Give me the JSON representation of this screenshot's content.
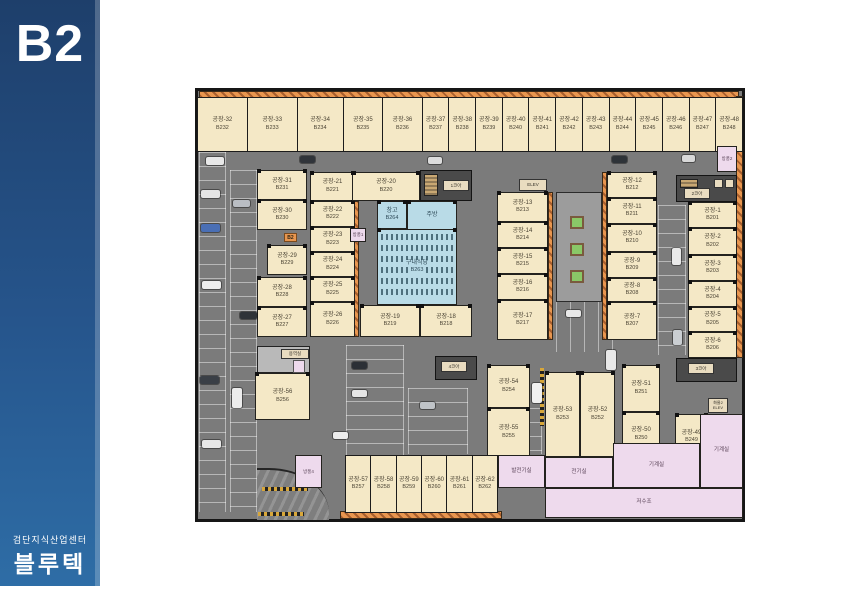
{
  "banner": {
    "level": "B2",
    "subtitle": "검단지식산업센터",
    "name": "블루텍"
  },
  "top_row": [
    {
      "label": "공장-32",
      "code": "B232"
    },
    {
      "label": "공장-33",
      "code": "B233"
    },
    {
      "label": "공장-34",
      "code": "B234"
    },
    {
      "label": "공장-35",
      "code": "B235"
    },
    {
      "label": "공장-36",
      "code": "B236"
    },
    {
      "label": "공장-37",
      "code": "B237"
    },
    {
      "label": "공장-38",
      "code": "B238"
    },
    {
      "label": "공장-39",
      "code": "B239"
    },
    {
      "label": "공장-40",
      "code": "B240"
    },
    {
      "label": "공장-41",
      "code": "B241"
    },
    {
      "label": "공장-42",
      "code": "B242"
    },
    {
      "label": "공장-43",
      "code": "B243"
    },
    {
      "label": "공장-44",
      "code": "B244"
    },
    {
      "label": "공장-45",
      "code": "B245"
    },
    {
      "label": "공장-46",
      "code": "B246"
    },
    {
      "label": "공장-47",
      "code": "B247"
    },
    {
      "label": "공장-48",
      "code": "B248"
    }
  ],
  "left_col_a": [
    {
      "label": "공장-31",
      "code": "B231"
    },
    {
      "label": "공장-30",
      "code": "B230"
    },
    {
      "label": "공장-29",
      "code": "B229"
    },
    {
      "label": "공장-28",
      "code": "B228"
    },
    {
      "label": "공장-27",
      "code": "B227"
    }
  ],
  "left_col_b": [
    {
      "label": "공장-21",
      "code": "B221"
    },
    {
      "label": "공장-22",
      "code": "B222"
    },
    {
      "label": "공장-23",
      "code": "B223"
    },
    {
      "label": "공장-24",
      "code": "B224"
    },
    {
      "label": "공장-25",
      "code": "B225"
    },
    {
      "label": "공장-26",
      "code": "B226"
    }
  ],
  "center": {
    "f20": {
      "label": "공장-20",
      "code": "B220"
    },
    "storage": {
      "label": "창고",
      "code": "B264"
    },
    "kitchen": {
      "label": "주방"
    },
    "cafeteria": {
      "label": "구내식당",
      "code": "B263"
    },
    "f19": {
      "label": "공장-19",
      "code": "B219"
    },
    "f18": {
      "label": "공장-18",
      "code": "B218"
    }
  },
  "mid_col": [
    {
      "label": "공장-13",
      "code": "B213"
    },
    {
      "label": "공장-14",
      "code": "B214"
    },
    {
      "label": "공장-15",
      "code": "B215"
    },
    {
      "label": "공장-16",
      "code": "B216"
    },
    {
      "label": "공장-17",
      "code": "B217"
    }
  ],
  "right_col": [
    {
      "label": "공장-12",
      "code": "B212"
    },
    {
      "label": "공장-11",
      "code": "B211"
    },
    {
      "label": "공장-10",
      "code": "B210"
    },
    {
      "label": "공장-9",
      "code": "B209"
    },
    {
      "label": "공장-8",
      "code": "B208"
    },
    {
      "label": "공장-7",
      "code": "B207"
    }
  ],
  "far_col": [
    {
      "label": "공장-1",
      "code": "B201"
    },
    {
      "label": "공장-2",
      "code": "B202"
    },
    {
      "label": "공장-3",
      "code": "B203"
    },
    {
      "label": "공장-4",
      "code": "B204"
    },
    {
      "label": "공장-5",
      "code": "B205"
    },
    {
      "label": "공장-6",
      "code": "B206"
    }
  ],
  "bottom_block": {
    "f54": {
      "label": "공장-54",
      "code": "B254"
    },
    "f55": {
      "label": "공장-55",
      "code": "B255"
    },
    "f53": {
      "label": "공장-53",
      "code": "B253"
    },
    "f52": {
      "label": "공장-52",
      "code": "B252"
    },
    "f51": {
      "label": "공장-51",
      "code": "B251"
    },
    "f50": {
      "label": "공장-50",
      "code": "B250"
    },
    "f49": {
      "label": "공장-49",
      "code": "B249"
    }
  },
  "bottom_row": [
    {
      "label": "공장-57",
      "code": "B257"
    },
    {
      "label": "공장-58",
      "code": "B258"
    },
    {
      "label": "공장-59",
      "code": "B259"
    },
    {
      "label": "공장-60",
      "code": "B260"
    },
    {
      "label": "공장-61",
      "code": "B261"
    },
    {
      "label": "공장-62",
      "code": "B262"
    }
  ],
  "f56": {
    "label": "공장-56",
    "code": "B256"
  },
  "cores": {
    "c1": "1코아",
    "c2": "2코아",
    "c3": "3코아",
    "c4": "4코아"
  },
  "utility": {
    "generator": "발전기실",
    "electrical": "전기실",
    "mechanical1": "기계실",
    "mechanical2": "기계실",
    "water_tank": "저수조",
    "service": "용역실"
  },
  "vestibules": {
    "v1": "방풍1",
    "v2": "방풍2",
    "v3": "방풍3",
    "v4": "방풍4"
  },
  "elevator": {
    "label": "ELEV"
  },
  "freight_elevator": {
    "line1": "화물2",
    "line2": "ELEV"
  },
  "marker": {
    "b2": "B2"
  },
  "colors": {
    "banner_blue": "#2a5e99",
    "room_cream": "#f4e8c6",
    "room_blue": "#b9dbe7",
    "room_pink": "#eedaed",
    "hatch_orange": "#e08c4a",
    "plan_gray": "#7b7b7b",
    "planter_green": "#8ac867"
  }
}
